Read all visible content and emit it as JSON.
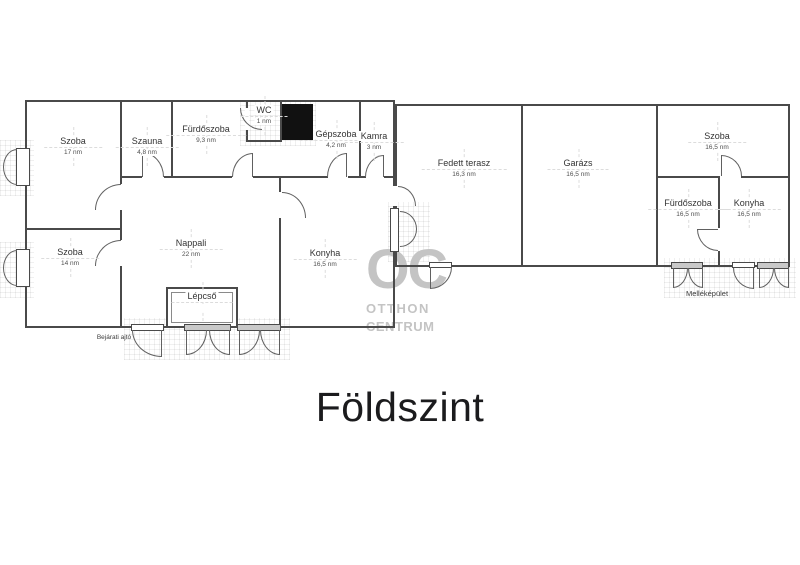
{
  "title": "Földszint",
  "watermark": {
    "logo_text": "OC",
    "line1": "OTTHON",
    "line2": "CENTRUM"
  },
  "annotations": {
    "entrance_door": "Bejárati ajtó",
    "outbuilding": "Melléképület"
  },
  "rooms": [
    {
      "name": "Szoba",
      "area": "17 nm"
    },
    {
      "name": "Szauna",
      "area": "4,8 nm"
    },
    {
      "name": "Fürdőszoba",
      "area": "9,3 nm"
    },
    {
      "name": "WC",
      "area": "1 nm"
    },
    {
      "name": "Gépszoba",
      "area": "4,2 nm"
    },
    {
      "name": "Kamra",
      "area": "3 nm"
    },
    {
      "name": "Nappali",
      "area": "22 nm"
    },
    {
      "name": "Szoba",
      "area": "14 nm"
    },
    {
      "name": "Konyha",
      "area": "16,5 nm"
    },
    {
      "name": "Lépcső",
      "area": ""
    },
    {
      "name": "Fedett terasz",
      "area": "16,3 nm"
    },
    {
      "name": "Garázs",
      "area": "16,5 nm"
    },
    {
      "name": "Szoba",
      "area": "16,5 nm"
    },
    {
      "name": "Fürdőszoba",
      "area": "16,5 nm"
    },
    {
      "name": "Konyha",
      "area": "16,5 nm"
    }
  ],
  "colors": {
    "wall": "#4a4a4a",
    "chimney": "#111111",
    "watermark": "#c4c4c4",
    "text": "#333333",
    "title": "#1b1b1d"
  }
}
